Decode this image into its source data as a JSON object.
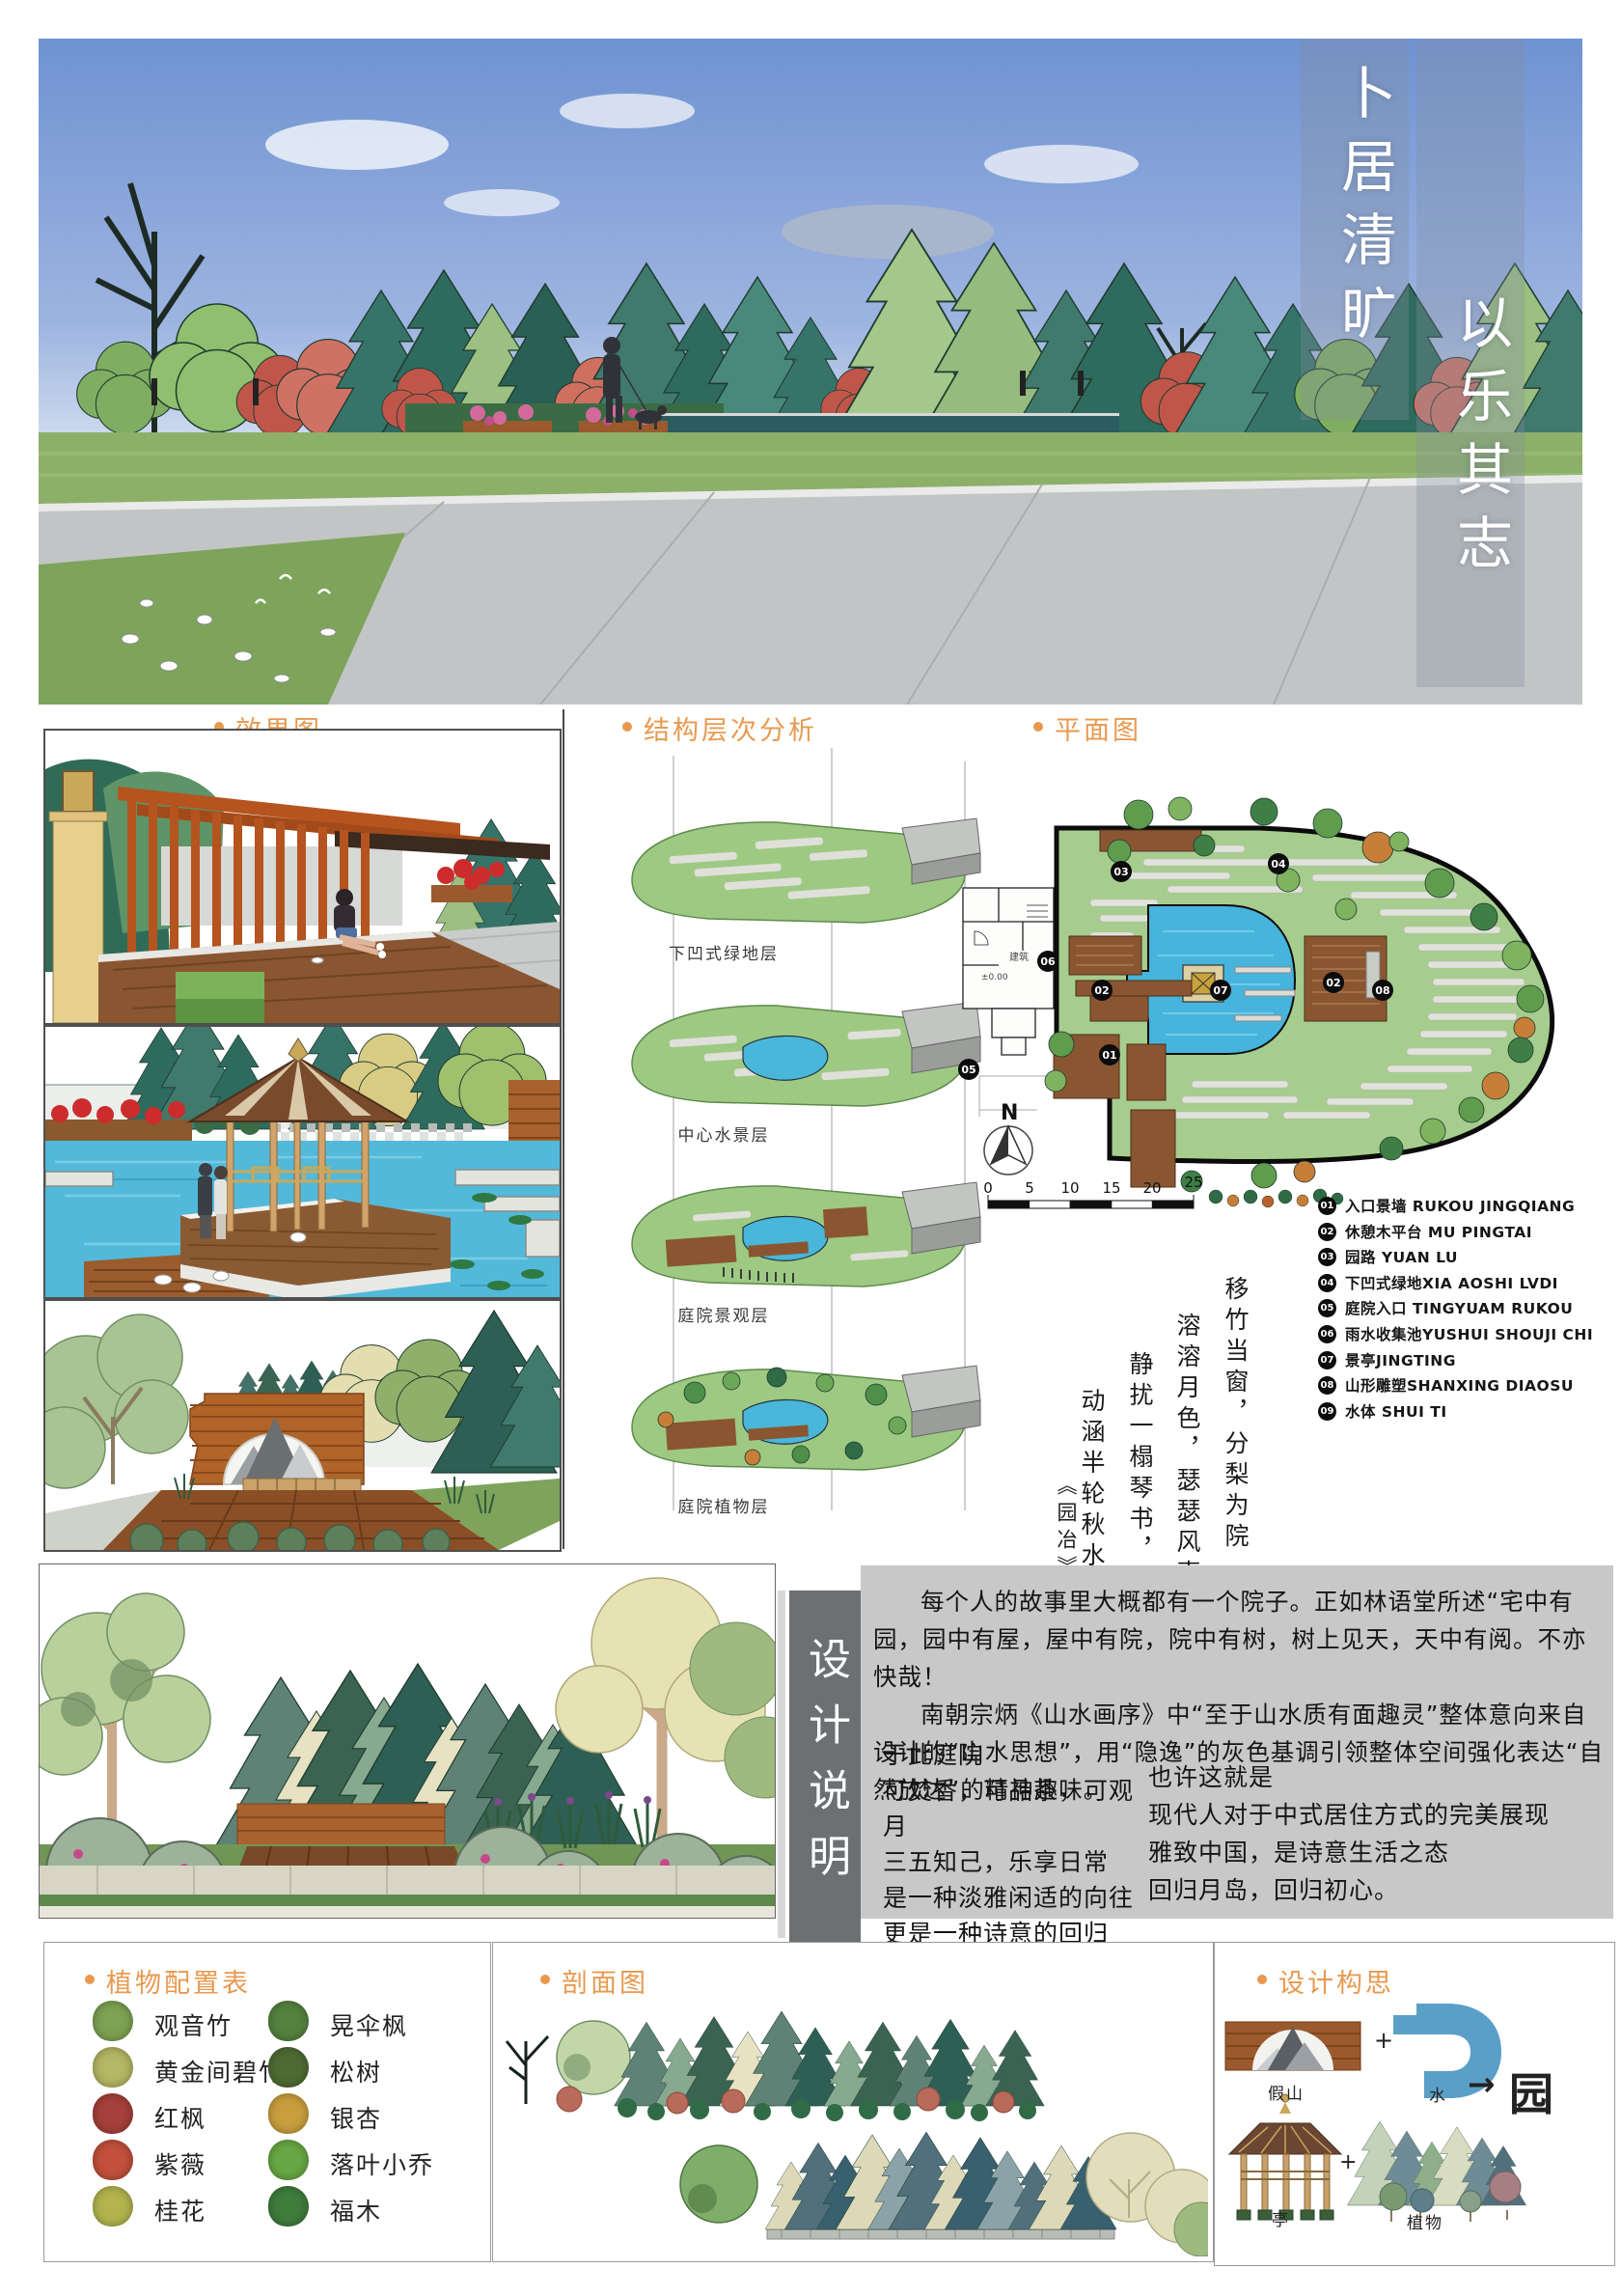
{
  "accent_color": "#E8994F",
  "banner": {
    "title_1": "卜居清旷",
    "title_2": "以乐其志"
  },
  "sections": {
    "effects": {
      "label": "效果图"
    },
    "structure": {
      "label": "结构层次分析",
      "layers": [
        "下凹式绿地层",
        "中心水景层",
        "庭院景观层",
        "庭院植物层"
      ]
    },
    "plan": {
      "label": "平面图",
      "compass": "N",
      "scale_ticks": [
        "0",
        "5",
        "10",
        "15",
        "20",
        "25"
      ],
      "building_labels": [
        "±0.00",
        "建筑"
      ],
      "markers": [
        "03",
        "04",
        "06",
        "02",
        "07",
        "02",
        "08",
        "01",
        "05"
      ],
      "legend": [
        {
          "num": "01",
          "text": "入口景墙 RUKOU JINGQIANG"
        },
        {
          "num": "02",
          "text": "休憩木平台 MU PINGTAI"
        },
        {
          "num": "03",
          "text": "园路 YUAN LU"
        },
        {
          "num": "04",
          "text": "下凹式绿地XIA AOSHI LVDI"
        },
        {
          "num": "05",
          "text": "庭院入口 TINGYUAM RUKOU"
        },
        {
          "num": "06",
          "text": "雨水收集池YUSHUI SHOUJI CHI"
        },
        {
          "num": "07",
          "text": "景亭JINGTING"
        },
        {
          "num": "08",
          "text": "山形雕塑SHANXING DIAOSU"
        },
        {
          "num": "09",
          "text": "水体 SHUI TI"
        }
      ]
    },
    "poem": {
      "lines": [
        "移竹当窗，分梨为院",
        "溶溶月色，瑟瑟风声",
        "静扰一榻琴书，",
        "动涵半轮秋水。",
        "《园冶》"
      ]
    },
    "design_notes": {
      "label": "设计说明",
      "para1": "每个人的故事里大概都有一个院子。正如林语堂所述“宅中有园，园中有屋，屋中有院，院中有树，树上见天，天中有阅。不亦快哉！",
      "para2": "南朝宗炳《山水画序》中“至于山水质有面趣灵”整体意向来自设计的“山水思想”，用“隐逸”的灰色基调引领整体空间强化表达“自然放达”的精神趣味。",
      "col1": [
        "于此庭院",
        "可焚香，可品茶，可观月",
        "三五知己，乐享日常",
        "是一种淡雅闲适的向往",
        "更是一种诗意的回归"
      ],
      "col2": [
        "也许这就是",
        "现代人对于中式居住方式的完美展现",
        "雅致中国，是诗意生活之态",
        "回归月岛，回归初心。"
      ]
    },
    "plants": {
      "label": "植物配置表",
      "left": [
        {
          "name": "观音竹",
          "color": "#7da253"
        },
        {
          "name": "黄金间碧竹",
          "color": "#b5b765"
        },
        {
          "name": "红枫",
          "color": "#a6403b"
        },
        {
          "name": "紫薇",
          "color": "#c2503c"
        },
        {
          "name": "桂花",
          "color": "#b3b44e"
        }
      ],
      "right": [
        {
          "name": "晃伞枫",
          "color": "#55823f"
        },
        {
          "name": "松树",
          "color": "#4f6b34"
        },
        {
          "name": "银杏",
          "color": "#c99f3e"
        },
        {
          "name": "落叶小乔",
          "color": "#68a844"
        },
        {
          "name": "福木",
          "color": "#3f7d3c"
        }
      ]
    },
    "sectionview": {
      "label": "剖面图"
    },
    "concept": {
      "label": "设计构思",
      "rock": "假山",
      "water": "水",
      "garden": "园",
      "pavilion": "亭",
      "plants": "植物",
      "plus": "+",
      "arrow": "→"
    }
  }
}
